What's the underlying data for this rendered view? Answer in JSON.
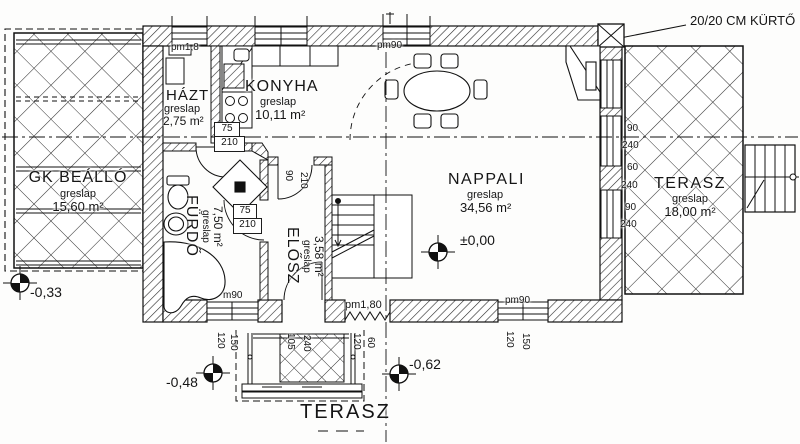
{
  "drawing": {
    "chimney_note": "20/20 CM KÜRTŐ",
    "rooms": {
      "carport": {
        "name": "GK BEÁLLÓ",
        "finish": "greslap",
        "area": "15,60 m²"
      },
      "household": {
        "name": "HÁZT",
        "finish": "greslap",
        "area": "2,75 m²"
      },
      "kitchen": {
        "name": "KONYHA",
        "finish": "greslap",
        "area": "10,11 m²"
      },
      "living": {
        "name": "NAPPALI",
        "finish": "greslap",
        "area": "34,56 m²"
      },
      "bathroom": {
        "name": "FÜRDŐ",
        "finish": "greslap",
        "area": "7,50 m²"
      },
      "hall": {
        "name": "ELŐSZ",
        "finish": "greslap",
        "area": "3,58 m²"
      },
      "terrace_east": {
        "name": "TERASZ",
        "finish": "greslap",
        "area": "18,00 m²"
      },
      "terrace_south": {
        "name": "TERASZ"
      }
    },
    "levels": {
      "main": "±0,00",
      "carport": "-0,33",
      "south_west": "-0,48",
      "south": "-0,62"
    },
    "openings": {
      "hazt_window": "pm1,8",
      "living_north_window": "pm90",
      "living_south_window_head": "pm90",
      "entry_head": "pm1,80",
      "bath_window_head": "m90",
      "hazt_door": [
        "75",
        "210"
      ],
      "bath_door": [
        "75",
        "210"
      ],
      "hall_door": [
        "90",
        "210"
      ],
      "east_wall_dims": [
        "90",
        "240",
        "60",
        "240",
        "90",
        "240"
      ],
      "bath_window_dims": [
        "120",
        "150"
      ],
      "living_south_window_dims": [
        "120",
        "150"
      ],
      "porch_dims": [
        "105",
        "240",
        "120",
        "60"
      ]
    }
  }
}
